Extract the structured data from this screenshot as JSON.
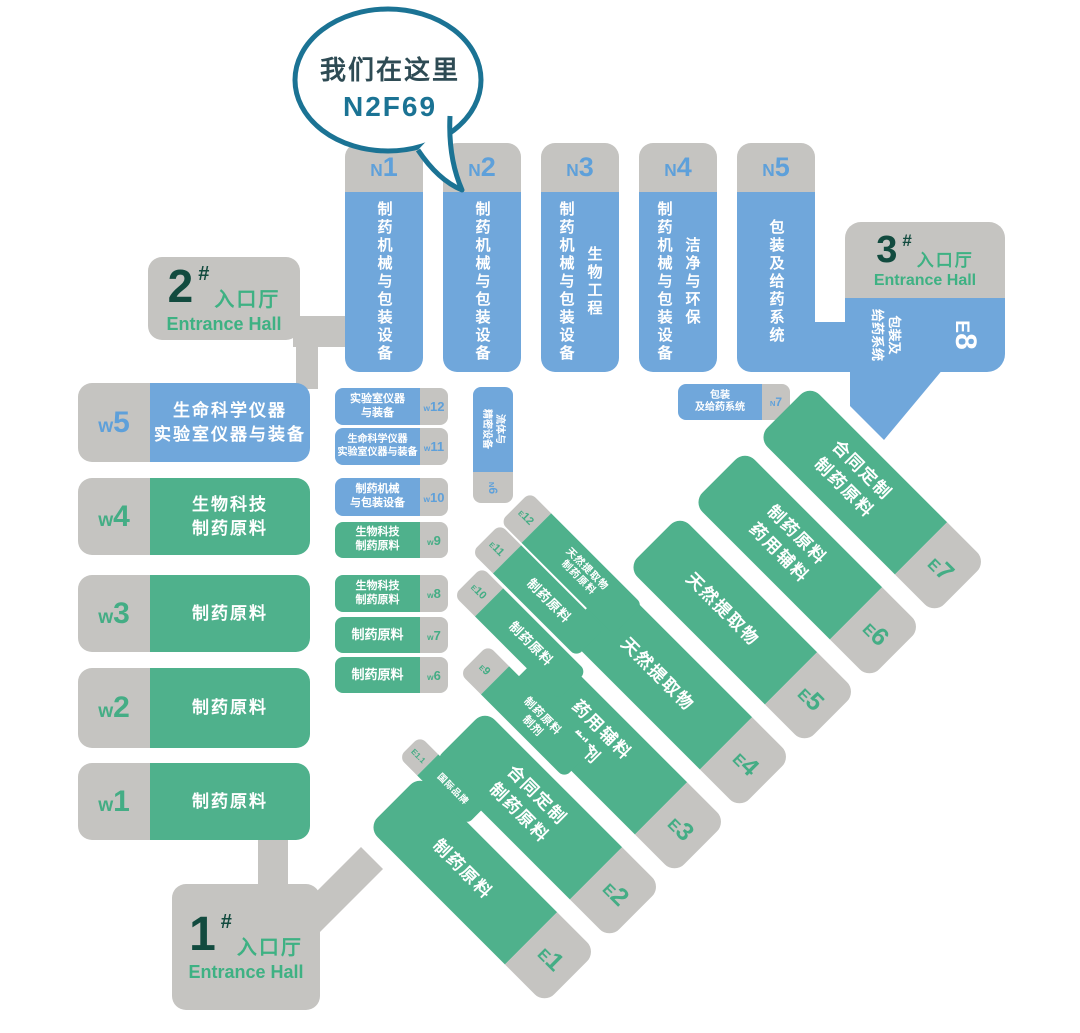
{
  "colors": {
    "blue": "#70A7DB",
    "green": "#4FB18C",
    "gray": "#C5C4C1",
    "blue_label": "#5EA0DA",
    "green_label": "#44AD85",
    "teal": "#1B7394",
    "bubble_dark": "#2E4B54",
    "dark_green": "#124B3F",
    "entrance_green": "#3EB183",
    "hall_text": "#FFFFFF"
  },
  "bubble": {
    "line1": "我们在这里",
    "line2": "N2F69"
  },
  "entrances": [
    {
      "num": "1",
      "hash": "#",
      "cn": "入口厅",
      "en": "Entrance Hall"
    },
    {
      "num": "2",
      "hash": "#",
      "cn": "入口厅",
      "en": "Entrance Hall"
    },
    {
      "num": "3",
      "hash": "#",
      "cn": "入口厅",
      "en": "Entrance Hall"
    }
  ],
  "n_halls": [
    {
      "label": "N1",
      "lines": [
        "制药机械与包装设备"
      ]
    },
    {
      "label": "N2",
      "lines": [
        "制药机械与包装设备"
      ]
    },
    {
      "label": "N3",
      "lines": [
        "制药机械与包装设备",
        "生物工程"
      ]
    },
    {
      "label": "N4",
      "lines": [
        "制药机械与包装设备",
        "洁净与环保"
      ]
    },
    {
      "label": "N5",
      "lines": [
        "包装及给药系统"
      ]
    }
  ],
  "w_large": [
    {
      "label": "w5",
      "lines": [
        "生命科学仪器",
        "实验室仪器与装备"
      ]
    },
    {
      "label": "w4",
      "lines": [
        "生物科技",
        "制药原料"
      ]
    },
    {
      "label": "w3",
      "lines": [
        "制药原料"
      ]
    },
    {
      "label": "w2",
      "lines": [
        "制药原料"
      ]
    },
    {
      "label": "w1",
      "lines": [
        "制药原料"
      ]
    }
  ],
  "w_small": [
    {
      "label": "w12",
      "lines": [
        "实验室仪器",
        "与装备"
      ]
    },
    {
      "label": "w11",
      "lines": [
        "生命科学仪器",
        "实验室仪器与装备"
      ]
    },
    {
      "label": "w10",
      "lines": [
        "制药机械",
        "与包装设备"
      ]
    },
    {
      "label": "w9",
      "lines": [
        "生物科技",
        "制药原料"
      ]
    },
    {
      "label": "w8",
      "lines": [
        "生物科技",
        "制药原料"
      ]
    },
    {
      "label": "w7",
      "lines": [
        "制药原料"
      ]
    },
    {
      "label": "w6",
      "lines": [
        "制药原料"
      ]
    }
  ],
  "n6": {
    "label": "N6",
    "lines": [
      "流体与",
      "精密设备"
    ]
  },
  "n7": {
    "label": "N7",
    "lines": [
      "包装",
      "及给药系统"
    ]
  },
  "e8": {
    "label": "E8",
    "lines": [
      "包装及",
      "给药系统"
    ]
  },
  "e_large": [
    {
      "label": "E1",
      "lines": [
        "制药原料"
      ]
    },
    {
      "label": "E2",
      "lines": [
        "合同定制",
        "制药原料"
      ]
    },
    {
      "label": "E3",
      "lines": [
        "药用辅料",
        "制剂"
      ]
    },
    {
      "label": "E4",
      "lines": [
        "天然提取物"
      ]
    },
    {
      "label": "E5",
      "lines": [
        "天然提取物"
      ]
    },
    {
      "label": "E6",
      "lines": [
        "制药原料",
        "药用辅料"
      ]
    },
    {
      "label": "E7",
      "lines": [
        "合同定制",
        "制药原料"
      ]
    }
  ],
  "e_small": [
    {
      "label": "E9",
      "lines": [
        "制药原料",
        "制剂"
      ]
    },
    {
      "label": "E10",
      "lines": [
        "制药原料"
      ]
    },
    {
      "label": "E11",
      "lines": [
        "制药原料"
      ]
    },
    {
      "label": "E12",
      "lines": [
        "天然提取物",
        "制药原料"
      ]
    },
    {
      "label": "E1.1",
      "lines": [
        "国际品牌"
      ]
    }
  ]
}
